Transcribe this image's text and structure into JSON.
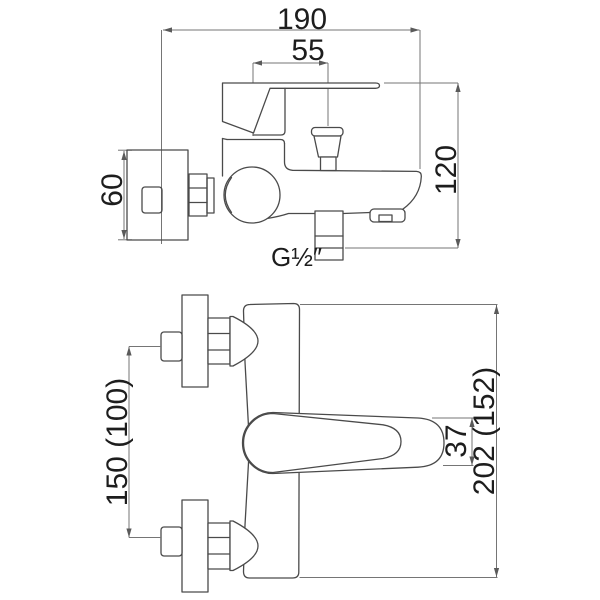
{
  "drawing": {
    "subject": "wall-mounted bath shower mixer tap dimensional drawing",
    "colors": {
      "background": "#ffffff",
      "outline": "#4a4a4a",
      "dimension_line": "#757575",
      "text": "#1d1d1d"
    },
    "side_view": {
      "dim_width": "190",
      "dim_diverter": "55",
      "dim_height": "120",
      "dim_plate": "60",
      "thread_label": "G½″"
    },
    "plan_view": {
      "dim_centers": "150 (100)",
      "dim_total": "202 (152)",
      "dim_lever": "37"
    }
  }
}
